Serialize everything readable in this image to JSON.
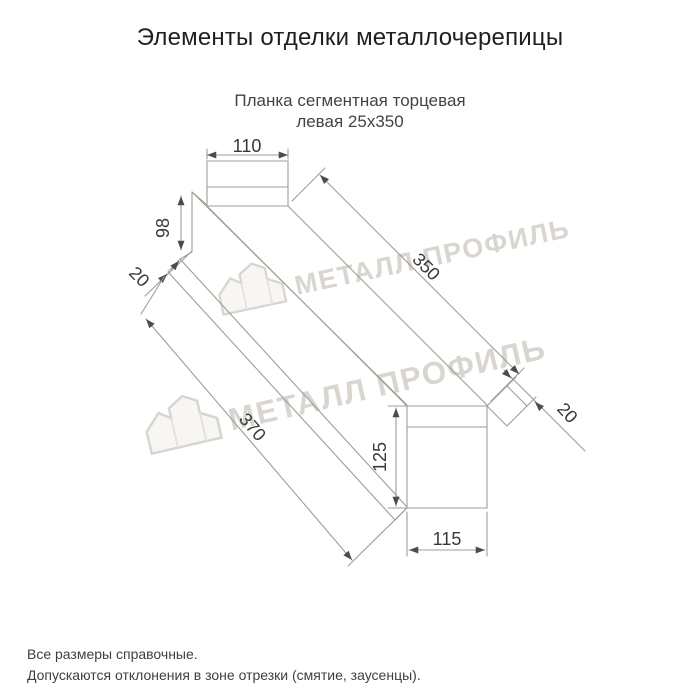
{
  "title": "Элементы отделки металлочерепицы",
  "subtitle": {
    "line1": "Планка сегментная торцевая",
    "line2": "левая 25х350"
  },
  "dimensions": {
    "top_width": "110",
    "left_height": "98",
    "left_hem": "20",
    "length_top": "350",
    "length_bottom": "370",
    "right_height": "125",
    "right_width": "115",
    "right_hem": "20"
  },
  "watermark": {
    "text": "МЕТАЛЛ ПРОФИЛЬ",
    "logo": "metall-profil-house-logo"
  },
  "footer": {
    "line1": "Все размеры справочные.",
    "line2": "Допускаются отклонения в зоне отрезки (смятие, заусенцы)."
  },
  "colors": {
    "background": "#ffffff",
    "drawing_line": "#a29c96",
    "dimension_text": "#383838",
    "arrow": "#4c4c4c",
    "title_text": "#1f1f1f",
    "subtitle_text": "#474241",
    "watermark": "#d9d5cf"
  }
}
